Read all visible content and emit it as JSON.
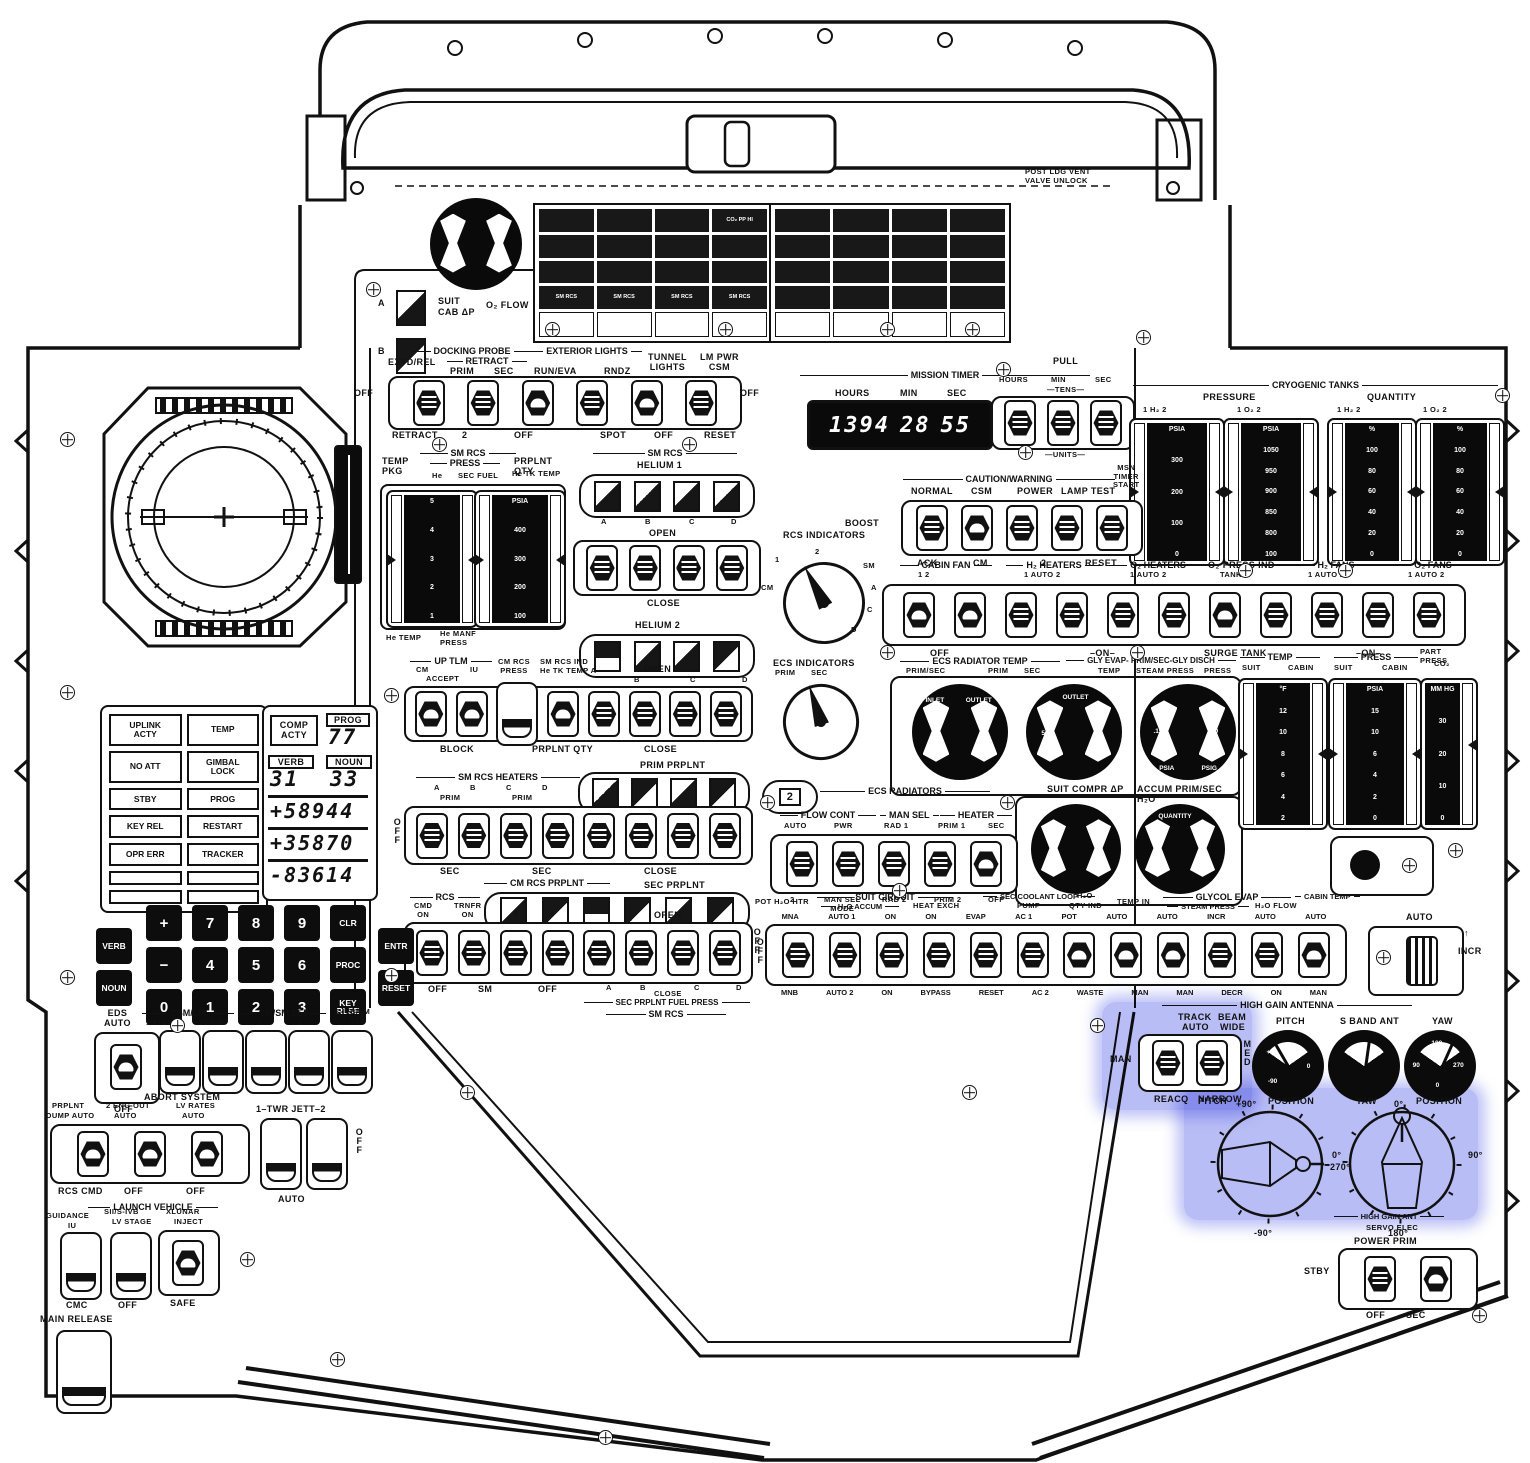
{
  "hatch": {
    "post_ldg": "POST LDG VENT\nVALVE UNLOCK"
  },
  "cb_left": {
    "cells": [
      "",
      "",
      "",
      "CO₂ PP HI",
      "",
      "",
      "",
      "",
      "",
      "",
      "",
      "",
      "SM RCS",
      "SM RCS",
      "SM RCS",
      "SM RCS",
      "",
      "",
      "",
      ""
    ]
  },
  "cb_right": {
    "cells": [
      "",
      "",
      "",
      "",
      "",
      "",
      "",
      "",
      "",
      "",
      "",
      "",
      "",
      "",
      "",
      "",
      "",
      "",
      "",
      ""
    ]
  },
  "suit_cab": {
    "a": "A",
    "b": "B",
    "l1": "SUIT",
    "l2": "CAB ΔP",
    "l3": "O₂ FLOW"
  },
  "docking": {
    "probe": "DOCKING PROBE",
    "extd_rel": "EXTD/REL",
    "retract": "RETRACT",
    "prim": "PRIM",
    "sec": "SEC",
    "ext_lights": "EXTERIOR LIGHTS",
    "run_eva": "RUN/EVA",
    "rndz": "RNDZ",
    "tunnel": "TUNNEL\nLIGHTS",
    "lm_pwr": "LM PWR\nCSM",
    "off_l": "OFF",
    "off_r": "OFF",
    "below": [
      "RETRACT",
      "2",
      "OFF",
      "SPOT",
      "OFF",
      "RESET"
    ]
  },
  "timer": {
    "title": "MISSION TIMER",
    "hours": "HOURS",
    "min": "MIN",
    "sec": "SEC",
    "d_h": "1394",
    "d_m": "28",
    "d_s": "55",
    "pull": "PULL",
    "set_hours": "HOURS",
    "set_min": "MIN",
    "set_sec": "SEC",
    "tens": "—TENS—",
    "units": "—UNITS—"
  },
  "cryo": {
    "title": "CRYOGENIC TANKS",
    "pressure": "PRESSURE",
    "quantity": "QUANTITY",
    "heads": [
      "1    H₂    2",
      "1    O₂    2",
      "1    H₂    2",
      "1    O₂    2"
    ],
    "s1": [
      "PSIA",
      "300",
      "200",
      "100",
      "0"
    ],
    "s2": [
      "PSIA",
      "1050",
      "950",
      "900",
      "850",
      "800",
      "100"
    ],
    "s3": [
      "%",
      "100",
      "80",
      "60",
      "40",
      "20",
      "0"
    ],
    "s4": [
      "%",
      "100",
      "80",
      "60",
      "40",
      "20",
      "0"
    ]
  },
  "cw": {
    "title": "CAUTION/WARNING",
    "boost": "BOOST",
    "normal": "NORMAL",
    "csm": "CSM",
    "power": "POWER",
    "lamp": "LAMP TEST",
    "msn": "MSN\nTIMER\nSTART",
    "ack": "ACK",
    "cm": "CM",
    "two": "2",
    "reset": "RESET"
  },
  "env": {
    "cabin_fan": "CABIN FAN",
    "h2_heaters": "H₂ HEATERS",
    "o2_heaters": "O₂ HEATERS",
    "o2_press": "O₂ PRESS IND",
    "h2_fans": "H₂ FANS",
    "o2_fans": "O₂ FANS",
    "subs": [
      "1          2",
      "1 AUTO 2",
      "1 AUTO 2",
      "TANK 1",
      "1 AUTO 2",
      "1 AUTO 2"
    ],
    "below": [
      "OFF",
      "–ON–",
      "SURGE TANK",
      "–ON–"
    ]
  },
  "rcs_sel": {
    "title": "RCS INDICATORS",
    "pos": [
      "CM",
      "1",
      "2",
      "SM",
      "A",
      "C",
      "D"
    ]
  },
  "rcs_gauges": {
    "temp_pkg": "TEMP\nPKG",
    "sm_rcs": "SM RCS",
    "press": "PRESS",
    "he": "He",
    "sec_fuel": "SEC FUEL",
    "prplnt": "PRPLNT QTY",
    "he_tk": "He TK TEMP",
    "ls": [
      "5",
      "4",
      "3",
      "2",
      "1"
    ],
    "rs": [
      "PSIA",
      "400",
      "300",
      "200",
      "100"
    ],
    "below1": "He TEMP",
    "below2": "He MANF\nPRESS"
  },
  "helium": {
    "sm_rcs": "SM RCS",
    "h1": "HELIUM 1",
    "letters": [
      "A",
      "B",
      "C",
      "D"
    ],
    "open1": "OPEN",
    "close1": "CLOSE",
    "h2": "HELIUM 2",
    "open2": "OPEN"
  },
  "center": {
    "up_tlm": "UP TLM",
    "cm": "CM",
    "accept": "ACCEPT",
    "iu": "IU",
    "cm_rcs": "CM RCS",
    "cm_rcs_press": "CM RCS\nPRESS",
    "sm_rcs_ind": "SM RCS IND\nHe TK TEMP A",
    "r1": [
      "B",
      "C",
      "D"
    ],
    "open": "OPEN",
    "block": "BLOCK",
    "prplnt_qty": "PRPLNT QTY",
    "close": "CLOSE",
    "prim_prplnt": "PRIM PRPLNT",
    "pp": [
      "A",
      "B",
      "C",
      "D"
    ],
    "pp_open": "OPEN",
    "heaters": "SM RCS HEATERS",
    "hl": [
      "A",
      "B",
      "C",
      "D"
    ],
    "prim1": "PRIM",
    "prim2": "PRIM",
    "off_v": "OFF",
    "sec1": "SEC",
    "sec2": "SEC",
    "close2": "CLOSE",
    "cmrcs_prplnt": "CM RCS PRPLNT",
    "sec_prplnt": "SEC PRPLNT",
    "rcs": "RCS",
    "cmd_on": "CMD\nON",
    "trnfr_on": "TRNFR\nON",
    "one": "1",
    "two": "2",
    "open3": "OPEN",
    "b1": "OFF",
    "b2": "SM",
    "b3": "OFF",
    "b4": "A",
    "b5": "B",
    "b6": "C",
    "b7": "D",
    "close3": "CLOSE",
    "fuel": "SEC PRPLNT FUEL PRESS",
    "smrcs2": "SM RCS",
    "off_r": "OFF"
  },
  "ecs_sel": {
    "title": "ECS INDICATORS",
    "prim": "PRIM",
    "sec": "SEC"
  },
  "ecs_gauges": {
    "t1": "ECS RADIATOR TEMP",
    "s1a": "PRIM/SEC",
    "s1b": "PRIM",
    "s1c": "SEC",
    "t2": "GLY EVAP- PRIM/SEC-GLY DISCH",
    "s2a": "TEMP",
    "s2b": "STEAM PRESS",
    "s2c": "PRESS",
    "g1": [
      "INLET",
      "OUTLET"
    ],
    "g2": [
      "OUTLET",
      "70",
      "50",
      "30"
    ],
    "g3": [
      ".25",
      ".15",
      ".05",
      "60",
      "30",
      "0",
      "PSIA",
      "PSIG"
    ]
  },
  "suit_compr": {
    "l1": "SUIT COMPR ΔP",
    "l2": "ACCUM PRIM/SEC H₂O",
    "qty": "QUANTITY"
  },
  "ecs_rad": {
    "title": "ECS RADIATORS",
    "tb": "2",
    "flow": "FLOW CONT",
    "mansel": "MAN SEL",
    "heater": "HEATER",
    "top": [
      "AUTO",
      "PWR",
      "RAD 1",
      "PRIM 1",
      "SEC"
    ],
    "bottom": [
      "2",
      "MAN SEL\nMODE",
      "RAD 2",
      "PRIM 2",
      "OFF"
    ]
  },
  "cabin_gauges": {
    "temp": "TEMP",
    "suit1": "SUIT",
    "cabin1": "CABIN",
    "press": "PRESS",
    "suit2": "SUIT",
    "cabin2": "CABIN",
    "part": "PART PRESS",
    "co2": "CO₂",
    "ts": [
      "°F",
      "12",
      "10",
      "8",
      "6",
      "4",
      "2"
    ],
    "ps": [
      "PSIA",
      "15",
      "10",
      "6",
      "4",
      "2",
      "0"
    ],
    "cs": [
      "MM HG",
      "30",
      "20",
      "10",
      "0"
    ]
  },
  "long_row": {
    "pot": "POT H₂O HTR",
    "suit_circuit": "SUIT CIRCUIT",
    "h2o_accum": "H₂O ACCUM",
    "heat_exch": "HEAT EXCH",
    "sec_loop": "SEC COOLANT LOOP",
    "pump": "PUMP",
    "h2o": "H₂O",
    "qty_ind": "QTY IND",
    "temp_in": "TEMP IN",
    "glycol": "GLYCOL EVAP",
    "steam": "STEAM PRESS",
    "h2o_flow": "H₂O FLOW",
    "cabin_temp": "CABIN TEMP",
    "off": "OFF",
    "top": [
      "MNA",
      "AUTO 1",
      "ON",
      "ON",
      "EVAP",
      "AC 1",
      "POT",
      "AUTO",
      "AUTO",
      "INCR",
      "AUTO",
      "AUTO"
    ],
    "bottom": [
      "MNB",
      "AUTO 2",
      "ON",
      "BYPASS",
      "RESET",
      "AC 2",
      "WASTE",
      "MAN",
      "MAN",
      "DECR",
      "ON",
      "MAN"
    ]
  },
  "cabin_temp": {
    "auto": "AUTO",
    "incr": "INCR",
    "arrow": "↑"
  },
  "hga": {
    "title": "HIGH GAIN ANTENNA",
    "track": "TRACK",
    "auto": "AUTO",
    "man": "MAN",
    "reacq": "REACQ",
    "beam": "BEAM",
    "wide": "WIDE",
    "med": "MED",
    "narrow": "NARROW",
    "pitch": "PITCH",
    "sband": "S BAND ANT",
    "yaw": "YAW",
    "pm": [
      "+90",
      "0",
      "-90"
    ],
    "ym": [
      "180",
      "90",
      "270",
      "0"
    ],
    "pp_t": "PITCH",
    "pp_v": "+90°",
    "pp_p": "POSITION",
    "yp_t": "YAW",
    "yp_v": "0°",
    "yp_p": "POSITION",
    "d0": "0°",
    "d270": "270°",
    "dm90": "-90°",
    "d90": "90°",
    "d180": "180°",
    "servo1": "HIGH GAIN ANT",
    "servo2": "SERVO ELEC",
    "power": "POWER   PRIM",
    "stby": "STBY",
    "off": "OFF",
    "sec": "SEC"
  },
  "dsky": {
    "lights": [
      "UPLINK\nACTY",
      "TEMP",
      "NO ATT",
      "GIMBAL\nLOCK",
      "STBY",
      "PROG",
      "KEY REL",
      "RESTART",
      "OPR ERR",
      "TRACKER",
      "",
      "",
      "",
      ""
    ],
    "comp": "COMP\nACTY",
    "prog": "PROG",
    "prog_v": "77",
    "verb": "VERB",
    "verb_v": "31",
    "noun": "NOUN",
    "noun_v": "33",
    "r1": "+58944",
    "r2": "+35870",
    "r3": "-83614",
    "c1": [
      "VERB",
      "NOUN"
    ],
    "c2": [
      "+",
      "−",
      "0"
    ],
    "c3": [
      "7",
      "4",
      "1"
    ],
    "c4": [
      "8",
      "5",
      "2"
    ],
    "c5": [
      "9",
      "6",
      "3"
    ],
    "c6": [
      "CLR",
      "PROC",
      "KEY\nRLSE"
    ],
    "c7": [
      "ENTR",
      "RESET"
    ]
  },
  "eds": {
    "eds": "EDS\nAUTO",
    "off": "OFF",
    "csm_lm": "CSM/LM",
    "final": "1-FINAL",
    "sep2": "SEP-2",
    "cmsm": "CM/SM SEP",
    "one": "1",
    "two": "2",
    "sivb": "S-IVB/LM",
    "sep": "SEP"
  },
  "abort": {
    "title": "ABORT SYSTEM",
    "prplnt": "PRPLNT",
    "eng": "2 ENG OUT",
    "lv_rates": "LV RATES",
    "dump": "DUMP AUTO",
    "a2": "AUTO",
    "a3": "AUTO",
    "twr": "1–TWR JETT–2",
    "off_v": "OFF",
    "b1": "RCS CMD",
    "b2": "OFF",
    "b3": "OFF",
    "auto_b": "AUTO"
  },
  "lv": {
    "title": "LAUNCH VEHICLE",
    "guidance": "GUIDANCE",
    "iu": "IU",
    "s2": "SII/S-IVB",
    "stage": "LV STAGE",
    "xlunar": "XLUNAR",
    "inject": "INJECT",
    "cmc": "CMC",
    "off": "OFF",
    "safe": "SAFE"
  },
  "main_release": "MAIN RELEASE"
}
